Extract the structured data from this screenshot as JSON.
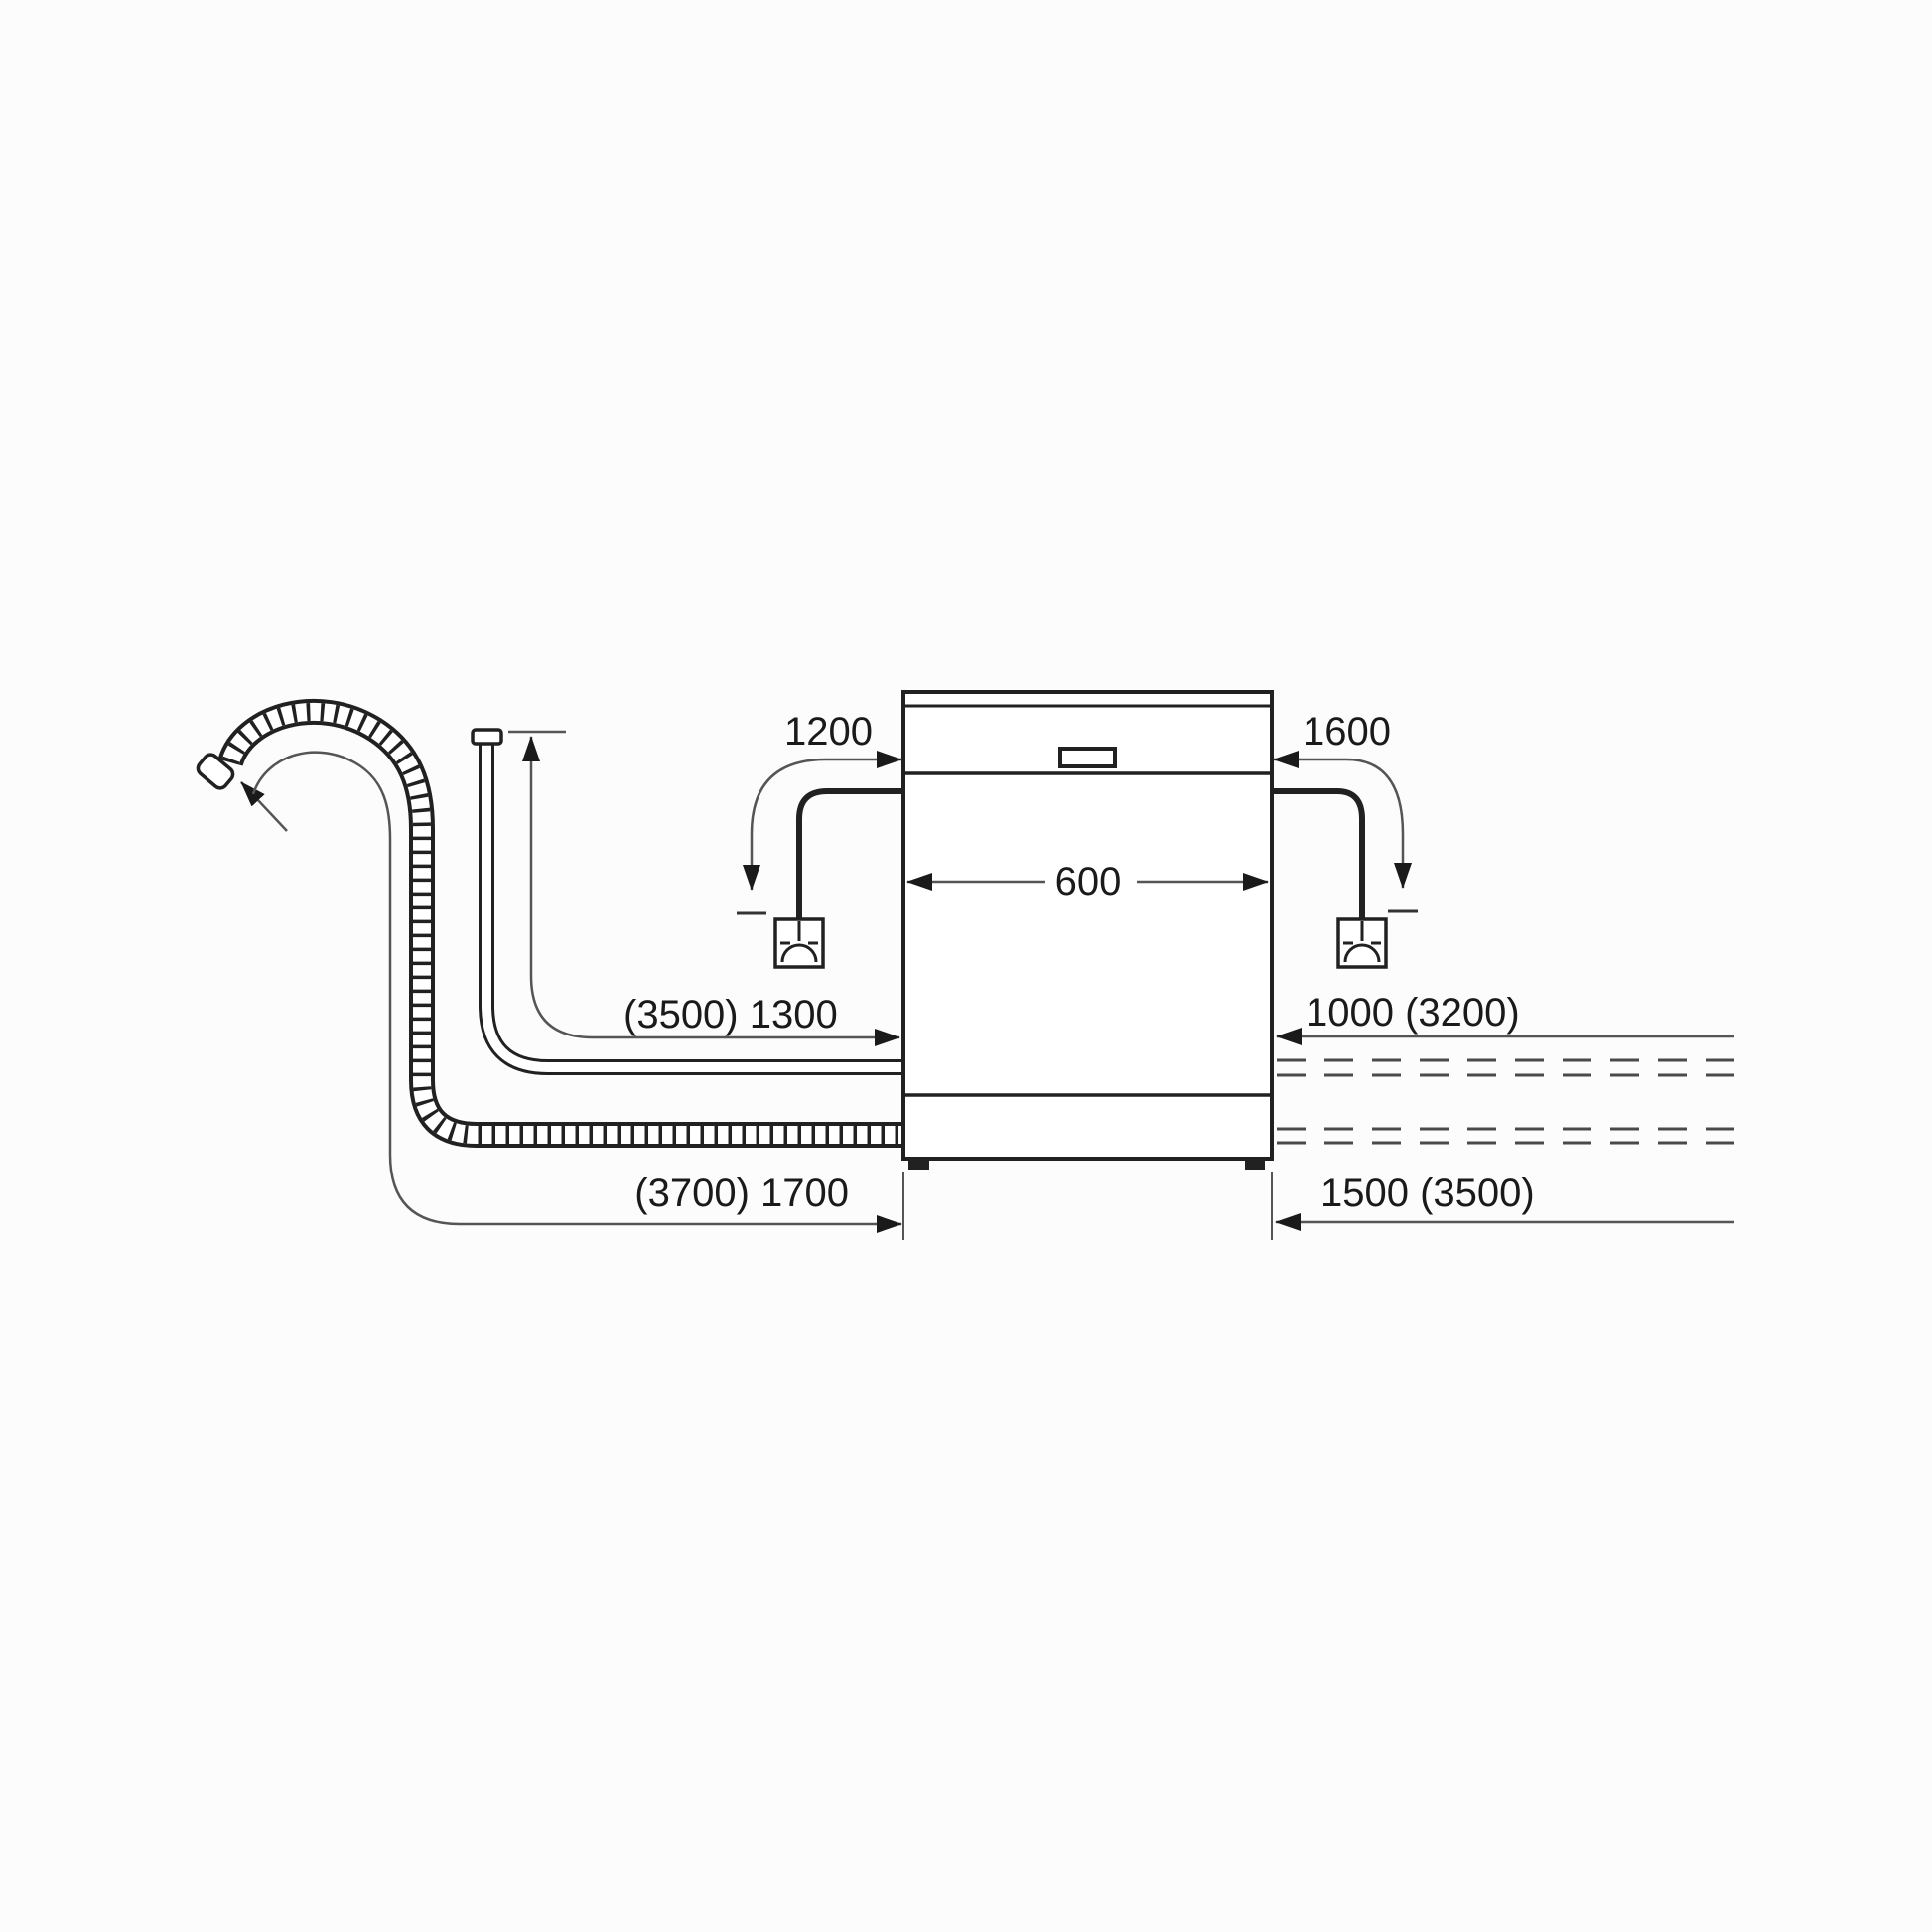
{
  "diagram": {
    "labels": {
      "cord_left": "1200",
      "cord_right": "1600",
      "appliance_width": "600",
      "inlet_left": "(3500) 1300",
      "inlet_right": "1000 (3200)",
      "drain_left": "(3700) 1700",
      "drain_right": "1500 (3500)"
    },
    "colors": {
      "outline": "#212121",
      "dimension_line": "#555555",
      "text": "#1a1a1a",
      "background": "#fcfcfc"
    },
    "icons": [
      "power-socket-icon",
      "drain-hose",
      "supply-hose",
      "power-cord",
      "arrowhead-icon"
    ]
  }
}
